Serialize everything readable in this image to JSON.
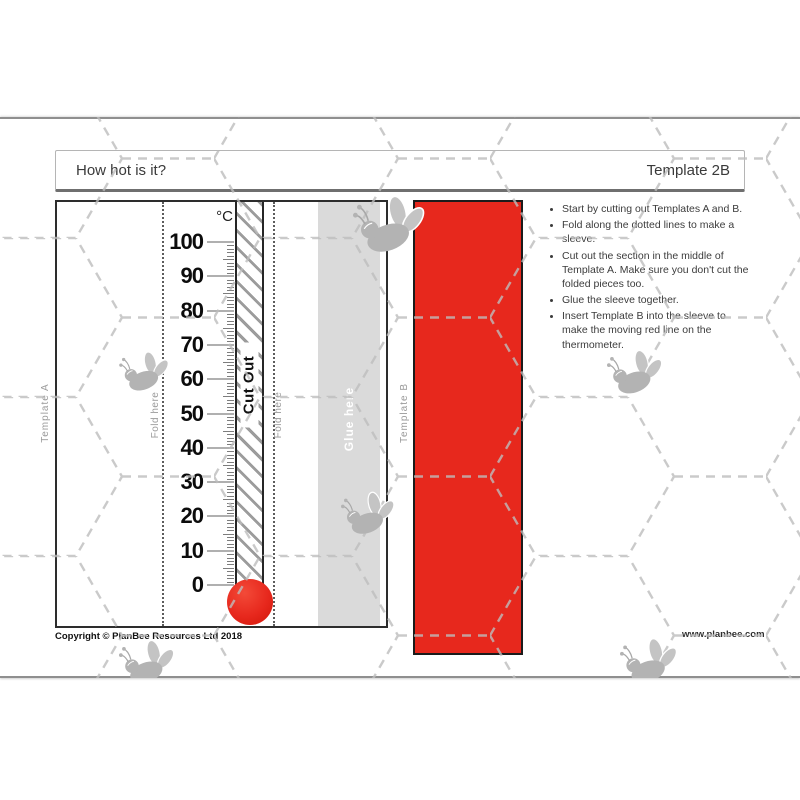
{
  "header": {
    "title": "How hot is it?",
    "template_label": "Template 2B"
  },
  "instructions": {
    "items": [
      "Start by cutting out Templates A and B.",
      "Fold along the dotted lines to make a sleeve.",
      "Cut out the section in the middle of Template A. Make sure you don't cut the folded pieces too.",
      "Glue the sleeve together.",
      "Insert Template B into the sleeve to make the moving red line on the thermometer."
    ]
  },
  "template_a": {
    "label": "Template A",
    "fold_left": "Fold here",
    "fold_right": "Fold here",
    "cut_out": "Cut Out",
    "glue": "Glue here"
  },
  "template_b": {
    "label": "Template B"
  },
  "chart_data": {
    "type": "thermometer-scale",
    "unit": "°C",
    "min": 0,
    "max": 100,
    "major_step": 10,
    "minor_step": 1,
    "major_labels": [
      100,
      90,
      80,
      70,
      60,
      50,
      40,
      30,
      20,
      10,
      0
    ],
    "bulb_value_color": "#e7281d"
  },
  "footer": {
    "copyright": "Copyright © PlanBee Resources Ltd 2018",
    "website": "www.planbee.com"
  },
  "colors": {
    "red": "#e7281d",
    "glue_gray": "#dadada",
    "bee_gray": "#b3b3b3",
    "hex_dash": "#bdbdbd"
  }
}
